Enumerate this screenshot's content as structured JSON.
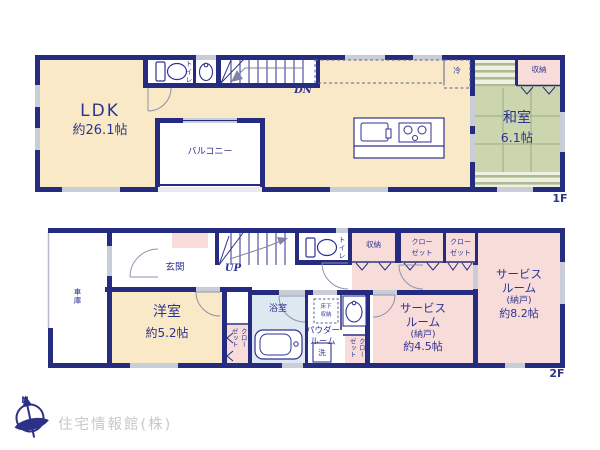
{
  "colors": {
    "wall": "#252b7e",
    "text": "#2d3390",
    "cream": "#f9e9c6",
    "pink": "#f8dcda",
    "tatami": "#cbd6ae",
    "bath_blue": "#dde8f1",
    "window_gray": "#c9cdd7",
    "company_gray": "#c8c8cc"
  },
  "floor1": {
    "label": "1F",
    "ldk": {
      "name": "LDK",
      "size": "約26.1帖"
    },
    "balcony": "バルコニー",
    "washitsu": {
      "name": "和室",
      "size": "6.1帖"
    },
    "toilet": "トイレ",
    "storage": "収納",
    "fridge": "冷",
    "stairs": "DN"
  },
  "floor2": {
    "label": "2F",
    "entrance": "玄関",
    "stairs": "UP",
    "garage": "車庫",
    "toilet": "トイレ",
    "storage": "収納",
    "closet_box_a": {
      "line1": "クロー",
      "line2": "ゼット"
    },
    "closet_box_b": {
      "line1": "クロー",
      "line2": "ゼット"
    },
    "closet_strip_west": {
      "line1": "クロー",
      "line2": "ゼット"
    },
    "closet_strip_center": {
      "line1": "クロー",
      "line2": "ゼット"
    },
    "western_room": {
      "name": "洋室",
      "size": "約5.2帖"
    },
    "bath": "浴室",
    "powder_room": {
      "line1": "パウダー",
      "line2": "ルーム"
    },
    "laundry": "洗",
    "underfloor_storage": {
      "line1": "床下",
      "line2": "収納"
    },
    "service_room_small": {
      "line1": "サービス",
      "line2": "ルーム",
      "line3": "(納戸)",
      "line4": "約4.5帖"
    },
    "service_room_large": {
      "line1": "サービス",
      "line2": "ルーム",
      "line3": "(納戸)",
      "line4": "約8.2帖"
    }
  },
  "footer": {
    "compass_north": "N",
    "company": "住宅情報館(株)"
  }
}
